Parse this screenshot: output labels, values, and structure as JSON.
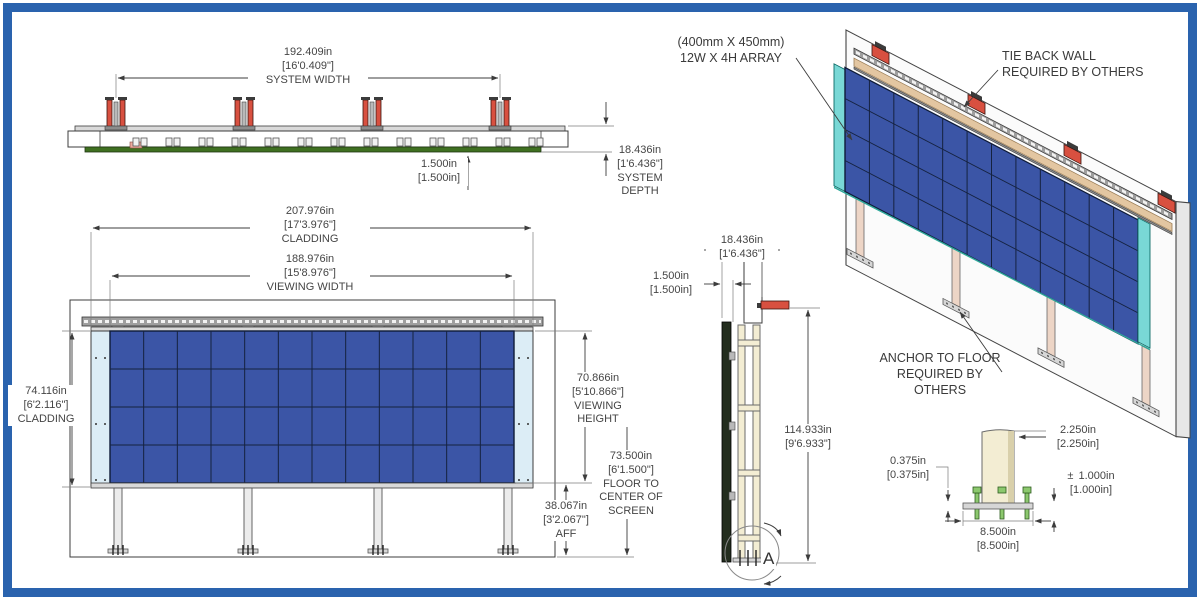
{
  "title": "LED display wall engineering drawing",
  "colors": {
    "border_blue": "#2a63ae",
    "panel_blue": "#3b55a6",
    "cladding_pale": "#dcedf6",
    "cladding_cyan": "#79d8d6",
    "bracket_red": "#d85040",
    "rail_tan": "#e3c6a1",
    "leg_cream": "#f3edd3",
    "leg_pink": "#edd5c6",
    "bolt_green": "#8cc86e",
    "strip_green": "#3f7021"
  },
  "views": {
    "top": {
      "system_width": {
        "in": "192.409in",
        "ft": "[16'0.409\"]",
        "label": "SYSTEM WIDTH"
      },
      "offset": {
        "in": "1.500in",
        "ft": "[1.500in]"
      },
      "system_depth": {
        "in": "18.436in",
        "ft": "[1'6.436\"]",
        "label": "SYSTEM DEPTH"
      }
    },
    "front": {
      "cladding_width": {
        "in": "207.976in",
        "ft": "[17'3.976\"]",
        "label": "CLADDING"
      },
      "viewing_width": {
        "in": "188.976in",
        "ft": "[15'8.976\"]",
        "label": "VIEWING WIDTH"
      },
      "cladding_height": {
        "in": "74.116in",
        "ft": "[6'2.116\"]",
        "label": "CLADDING"
      },
      "viewing_height": {
        "in": "70.866in",
        "ft": "[5'10.866\"]",
        "label": "VIEWING HEIGHT"
      },
      "floor_to_center": {
        "in": "73.500in",
        "ft": "[6'1.500\"]",
        "label": "FLOOR TO CENTER OF SCREEN"
      },
      "aff": {
        "in": "38.067in",
        "ft": "[3'2.067\"]",
        "label": "AFF"
      },
      "array": {
        "cols": 12,
        "rows": 4
      }
    },
    "side": {
      "system_depth": {
        "in": "18.436in",
        "ft": "[1'6.436\"]"
      },
      "offset": {
        "in": "1.500in",
        "ft": "[1.500in]"
      },
      "overall_height": {
        "in": "114.933in",
        "ft": "[9'6.933\"]"
      },
      "detail_marker": "A"
    },
    "iso": {
      "array_note_line1": "(400mm X 450mm)",
      "array_note_line2": "12W X 4H ARRAY",
      "tieback_line1": "TIE BACK WALL",
      "tieback_line2": "REQUIRED BY OTHERS",
      "anchor_line1": "ANCHOR TO FLOOR",
      "anchor_line2": "REQUIRED BY OTHERS"
    },
    "detail": {
      "post_depth": {
        "in": "2.250in",
        "ft": "[2.250in]"
      },
      "plate_thickness": {
        "in": "0.375in",
        "ft": "[0.375in]"
      },
      "bolt_projection": {
        "pm": "±",
        "in": "1.000in",
        "ft": "[1.000in]"
      },
      "plate_width": {
        "in": "8.500in",
        "ft": "[8.500in]"
      }
    }
  }
}
